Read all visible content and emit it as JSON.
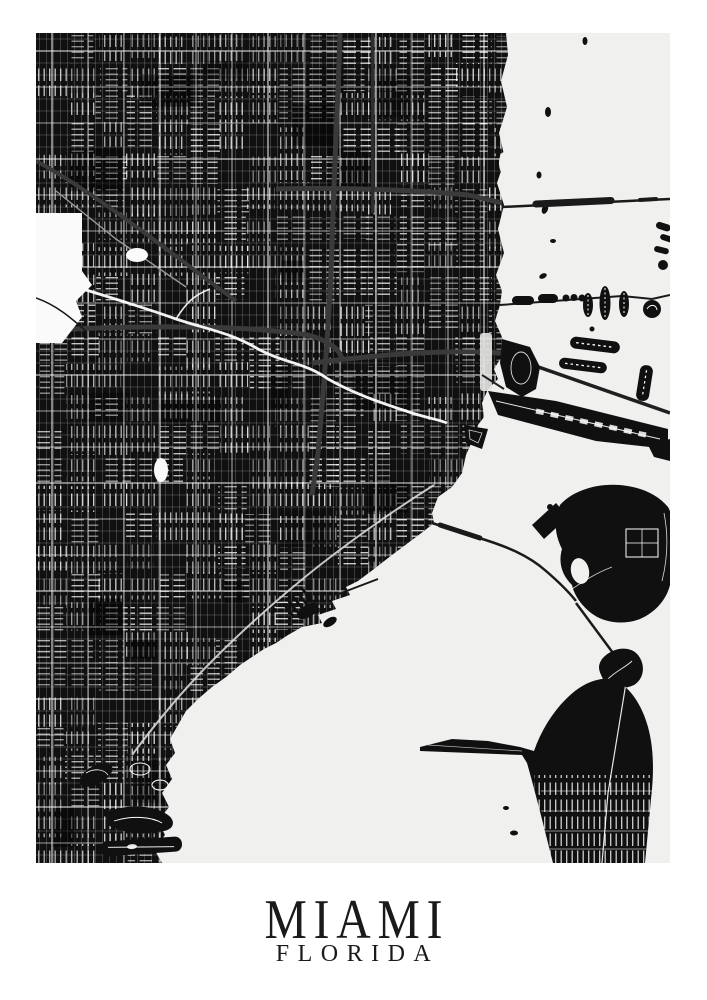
{
  "poster": {
    "title": "MIAMI",
    "subtitle": "FLORIDA",
    "background_color": "#ffffff",
    "text_color": "#1a1a1a"
  },
  "map": {
    "kind": "monochrome-street-map",
    "city": "Miami",
    "region": "Florida",
    "water_color": "#f0f0ee",
    "land_color": "#101010",
    "street_color": "#ffffff",
    "highway_color": "#3a3a3a",
    "park_color": "#fafafa"
  }
}
